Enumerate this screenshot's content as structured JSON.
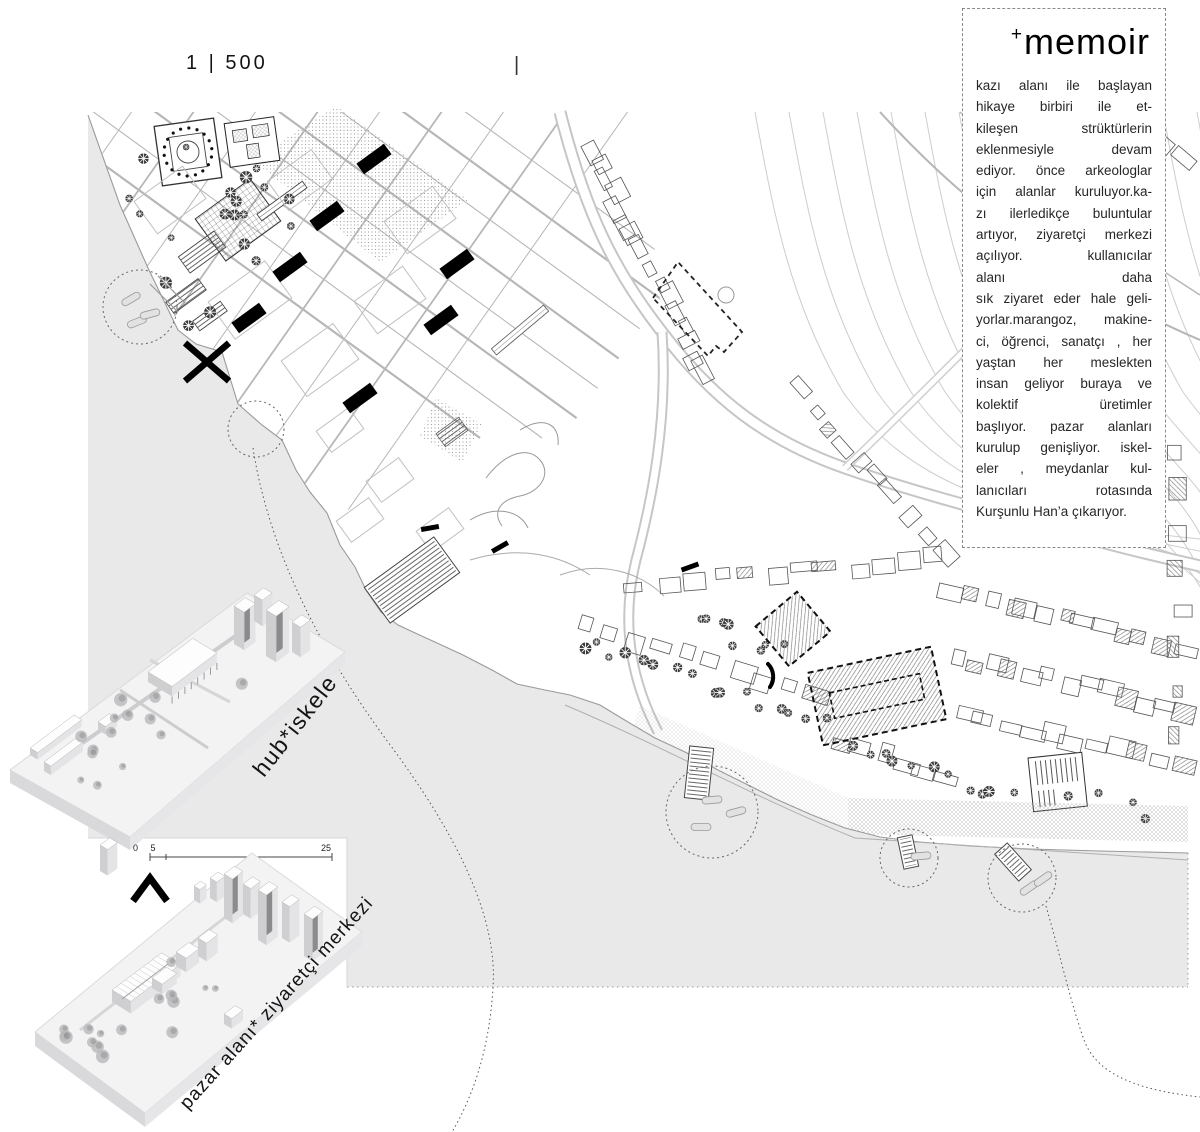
{
  "colors": {
    "sea": "#e9e9ea",
    "street": "#b7b7b7",
    "contour": "#cdcdcd",
    "ink": "#111111",
    "dash": "#6b6b6b"
  },
  "scale": {
    "label": "1 | 500",
    "tick": "|"
  },
  "scalebar": {
    "left_label": "0 5",
    "right_label": "25"
  },
  "memoir": {
    "title_plus": "+",
    "title": "memoir",
    "lines": [
      "kazı alanı ile başlayan",
      "hikaye birbiri ile et-",
      "kileşen strüktürlerin",
      "eklenmesiyle devam",
      "ediyor. önce arkeologlar",
      "için alanlar kuruluyor.ka-",
      "zı ilerledikçe buluntular",
      "artıyor, ziyaretçi merkezi",
      "açılıyor. kullanıcılar",
      "alanı daha",
      "sık ziyaret eder hale geli-",
      "yorlar.marangoz, makine-",
      "ci, öğrenci, sanatçı , her",
      "yaştan her meslekten",
      "insan geliyor buraya ve",
      "kolektif üretimler",
      "başlıyor. pazar alanları",
      "kurulup genişliyor. iskel-",
      "eler , meydanlar kul-",
      "lanıcıları rotasında",
      "Kurşunlu Han’a çıkarıyor."
    ]
  },
  "models": [
    {
      "name": "hub-iskele",
      "label": "hub*iskele"
    },
    {
      "name": "pazar-alani-ziyaretci-merkezi",
      "label": "pazar alanı*  ziyaretçi merkezi"
    }
  ],
  "map": {
    "highlight_circles": [
      {
        "cx": 140,
        "cy": 307,
        "r": 37
      },
      {
        "cx": 256,
        "cy": 429,
        "r": 28
      },
      {
        "cx": 712,
        "cy": 812,
        "r": 46
      },
      {
        "cx": 909,
        "cy": 858,
        "r": 29
      },
      {
        "cx": 1022,
        "cy": 878,
        "r": 34
      }
    ],
    "black_bars": [
      [
        374,
        159
      ],
      [
        327,
        216
      ],
      [
        290,
        267
      ],
      [
        249,
        318
      ],
      [
        457,
        264
      ],
      [
        441,
        320
      ],
      [
        360,
        398
      ]
    ],
    "small_dashes": [
      [
        430,
        528,
        -10
      ],
      [
        500,
        547,
        -30
      ],
      [
        690,
        567,
        -20
      ]
    ],
    "x_mark": {
      "x": 207,
      "y": 362,
      "size": 24
    },
    "north_caret": {
      "x": 150,
      "y": 889
    },
    "dashed_plots": [
      {
        "type": "rect",
        "cx": 793,
        "cy": 629,
        "w": 54,
        "h": 52,
        "rot": -40,
        "hatch": true
      },
      {
        "type": "rect",
        "cx": 877,
        "cy": 696,
        "w": 126,
        "h": 74,
        "rot": -12,
        "hatch": true,
        "inner": {
          "w": 92,
          "h": 26
        }
      },
      {
        "type": "path",
        "d": "M653,298 L678,262 L742,332 L724,352 L716,346 L708,356 Z",
        "circle": {
          "cx": 726,
          "cy": 295,
          "r": 8
        }
      }
    ],
    "piers": [
      {
        "cx": 412,
        "cy": 580,
        "w": 86,
        "h": 44,
        "rot": -36
      },
      {
        "cx": 699,
        "cy": 773,
        "w": 24,
        "h": 52,
        "rot": 6
      },
      {
        "cx": 908,
        "cy": 852,
        "w": 15,
        "h": 32,
        "rot": -12
      },
      {
        "cx": 1013,
        "cy": 862,
        "w": 17,
        "h": 36,
        "rot": -42
      }
    ],
    "boats": [
      [
        131,
        299,
        -30
      ],
      [
        137,
        322,
        -22
      ],
      [
        150,
        314,
        -15
      ],
      [
        712,
        800,
        -5
      ],
      [
        736,
        812,
        -15
      ],
      [
        701,
        827,
        0
      ],
      [
        921,
        856,
        -5
      ],
      [
        1029,
        888,
        -35
      ],
      [
        1043,
        879,
        -35
      ]
    ],
    "leader_curves": [
      "M253,448 C268,545 316,645 388,742 C458,836 498,918 493,988 C489,1052 472,1098 452,1132",
      "M1046,906 C1062,962 1070,1000 1084,1040 C1098,1078 1146,1091 1200,1097"
    ]
  }
}
